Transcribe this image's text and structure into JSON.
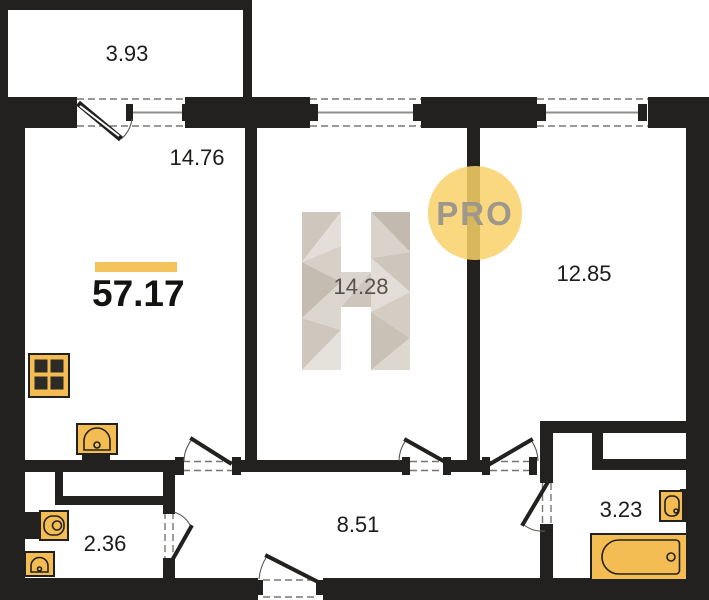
{
  "plan": {
    "total_area": "57.17",
    "rooms": {
      "balcony": "3.93",
      "living": "14.76",
      "room_center": "14.28",
      "room_right": "12.85",
      "hall": "8.51",
      "wc": "2.36",
      "bath": "3.23"
    },
    "watermark": {
      "badge_text": "PRO"
    }
  },
  "colors": {
    "wall": "#23211f",
    "accent": "#f5c35c",
    "fixture": "#f3bd53",
    "badge": "#f8d169",
    "badge_text": "#9d978c",
    "wm_text": "#57524c"
  }
}
